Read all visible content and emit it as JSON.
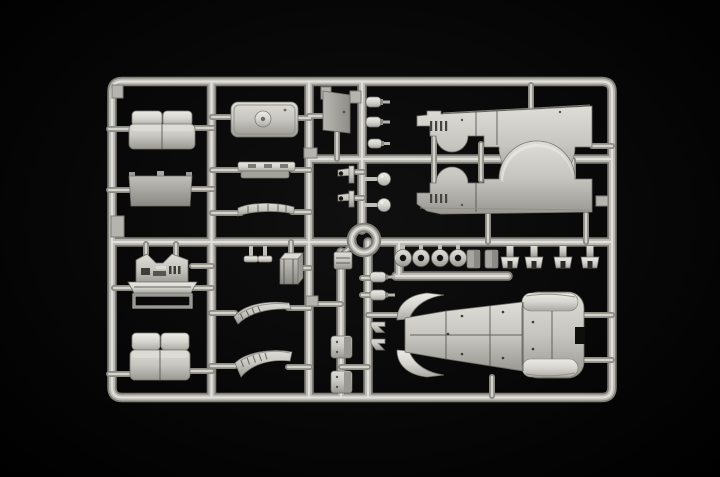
{
  "scene": {
    "type": "product-photo",
    "subject": "Light grey injection-moulded model kit sprue (runner frame) with unassembled vintage vehicle parts, photographed on a black background",
    "background_color": "#060606",
    "plastic_colors": {
      "highlight": "#e3e2dc",
      "light": "#d6d5cf",
      "mid": "#c6c5bf",
      "shadow": "#999892",
      "dark_detail": "#44433e"
    }
  },
  "sprue": {
    "frame": {
      "left": 112,
      "top": 81,
      "right": 612,
      "bottom": 398,
      "corner_radius": 10,
      "runner_width": 9
    },
    "center_ring": {
      "cx": 364,
      "cy": 240,
      "outer_radius": 17,
      "inner_radius": 8
    },
    "parts": [
      {
        "id": "bench-seat-upper",
        "label": "two-piece bench seat"
      },
      {
        "id": "cab-roof-panel",
        "label": "roof panel with dome vent"
      },
      {
        "id": "door-panel",
        "label": "flat door panel"
      },
      {
        "id": "windscreen-frame",
        "label": "windscreen panel"
      },
      {
        "id": "seat-rail",
        "label": "long seat rail"
      },
      {
        "id": "leaf-spring",
        "label": "curved leaf-spring brace"
      },
      {
        "id": "tow-hooks",
        "label": "two small tow hooks"
      },
      {
        "id": "gear-levers",
        "label": "two ball-headed levers"
      },
      {
        "id": "muffler-bullets",
        "label": "three bullet-shaped mufflers"
      },
      {
        "id": "cab-side-right",
        "label": "cab side panel with wheel-arch cutout and louvres (right)"
      },
      {
        "id": "cab-side-left",
        "label": "cab side panel with wheel-arch cutout and louvres (left)"
      },
      {
        "id": "engine-firewall",
        "label": "engine firewall with twin arches"
      },
      {
        "id": "floor-plate",
        "label": "trapezoid floor plate"
      },
      {
        "id": "open-frame",
        "label": "hollow rectangular frame"
      },
      {
        "id": "fuel-tank",
        "label": "box-shaped fuel tank"
      },
      {
        "id": "pedal-parts",
        "label": "two T-shaped pedals"
      },
      {
        "id": "wheel-hubs",
        "label": "four round hubs with centre holes"
      },
      {
        "id": "mount-plugs",
        "label": "two solid mounting plugs"
      },
      {
        "id": "bracket-clips",
        "label": "four bracket clips"
      },
      {
        "id": "fender-skirt-upper",
        "label": "ribbed fender skirt (upper)"
      },
      {
        "id": "fender-skirt-lower",
        "label": "ribbed fender skirt (lower)"
      },
      {
        "id": "bench-seat-lower",
        "label": "two-piece bench seat (second)"
      },
      {
        "id": "small-plates",
        "label": "two small plates"
      },
      {
        "id": "towing-clamps",
        "label": "two small hook clamps"
      },
      {
        "id": "axle-bullets",
        "label": "two bullet-shaped axle ends"
      },
      {
        "id": "main-body-tub",
        "label": "main body tub with four fenders"
      }
    ]
  }
}
